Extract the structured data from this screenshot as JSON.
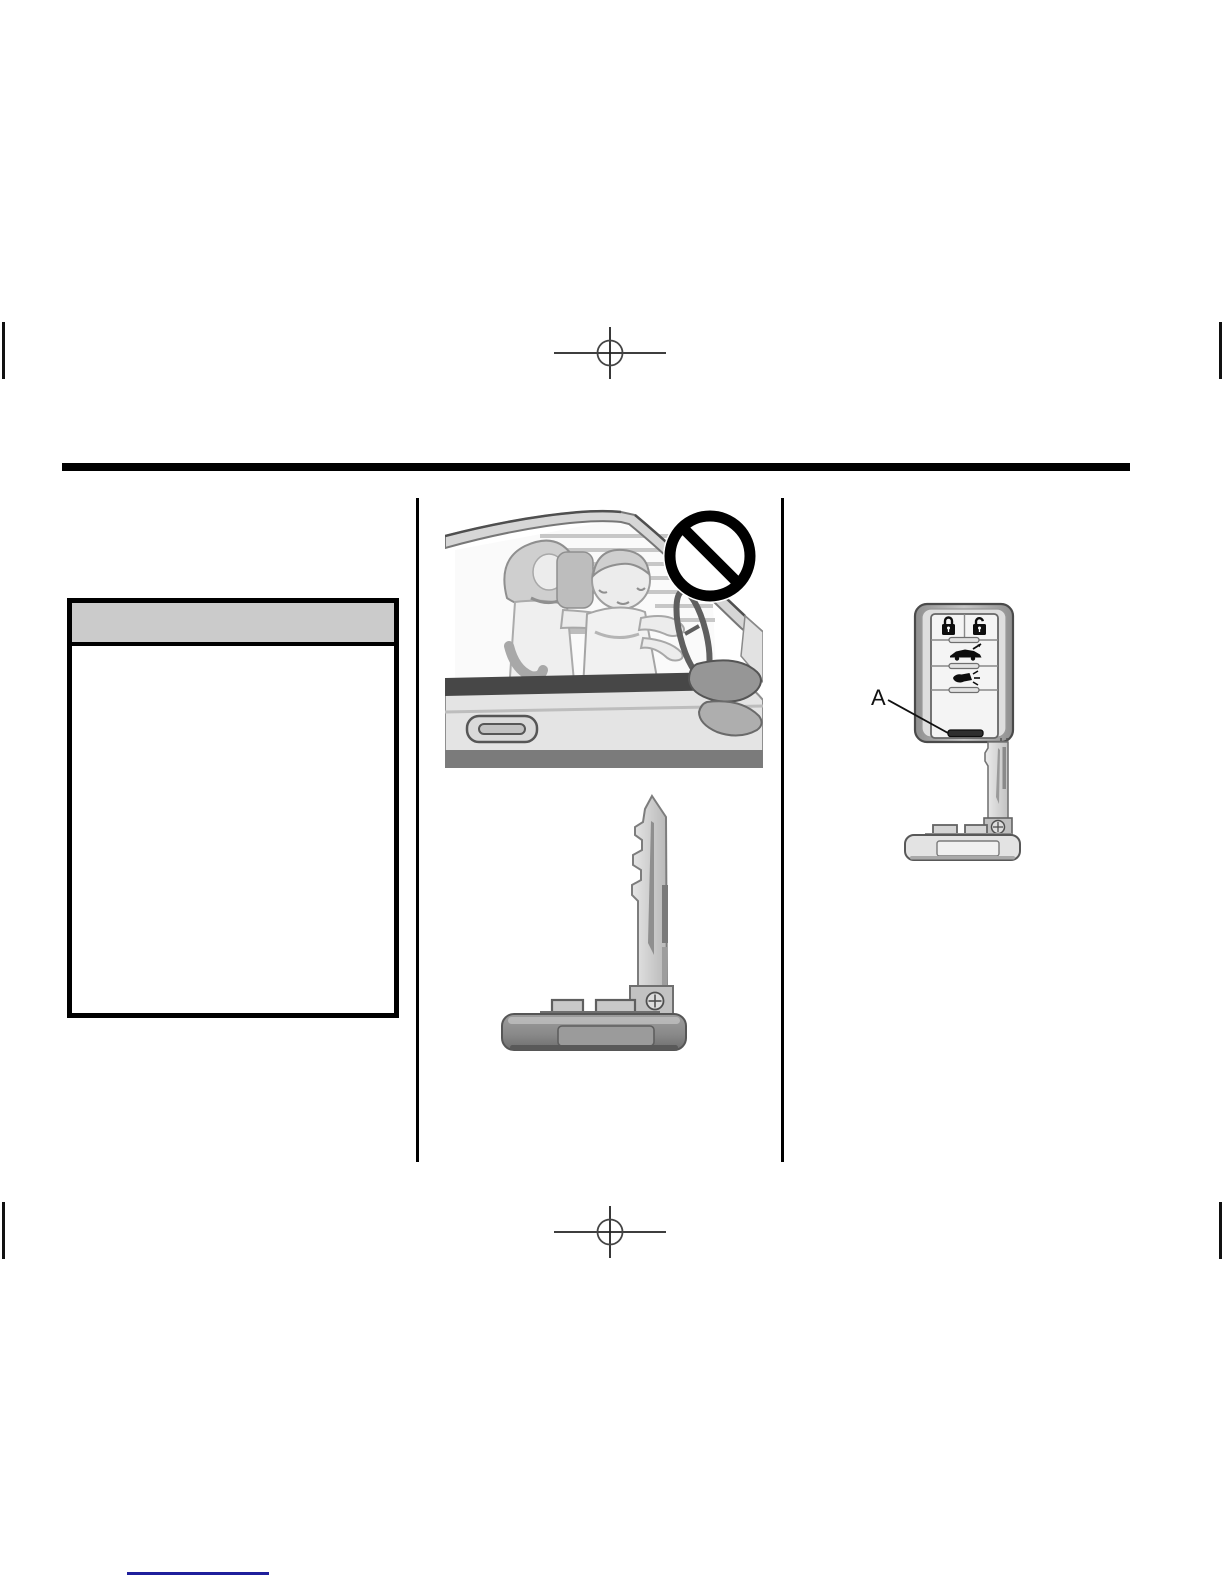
{
  "warning_box": {
    "title": ""
  },
  "callout": {
    "label": "A"
  },
  "icons": {
    "prohibition": "no-symbol-icon",
    "lock": "lock-icon",
    "unlock": "unlock-icon",
    "trunk_release": "trunk-icon",
    "panic_horn": "horn-icon",
    "key_release_slot": "key-release-slot",
    "registration_mark": "crosshair-registration-mark",
    "crop_mark": "crop-tick-mark",
    "screw": "screw-icon"
  },
  "colors": {
    "page_bg": "#ffffff",
    "rule": "#000000",
    "warning_header": "#cbcbcb",
    "warning_border": "#000000",
    "divider": "#000000",
    "link_line": "#1f1f9c"
  }
}
